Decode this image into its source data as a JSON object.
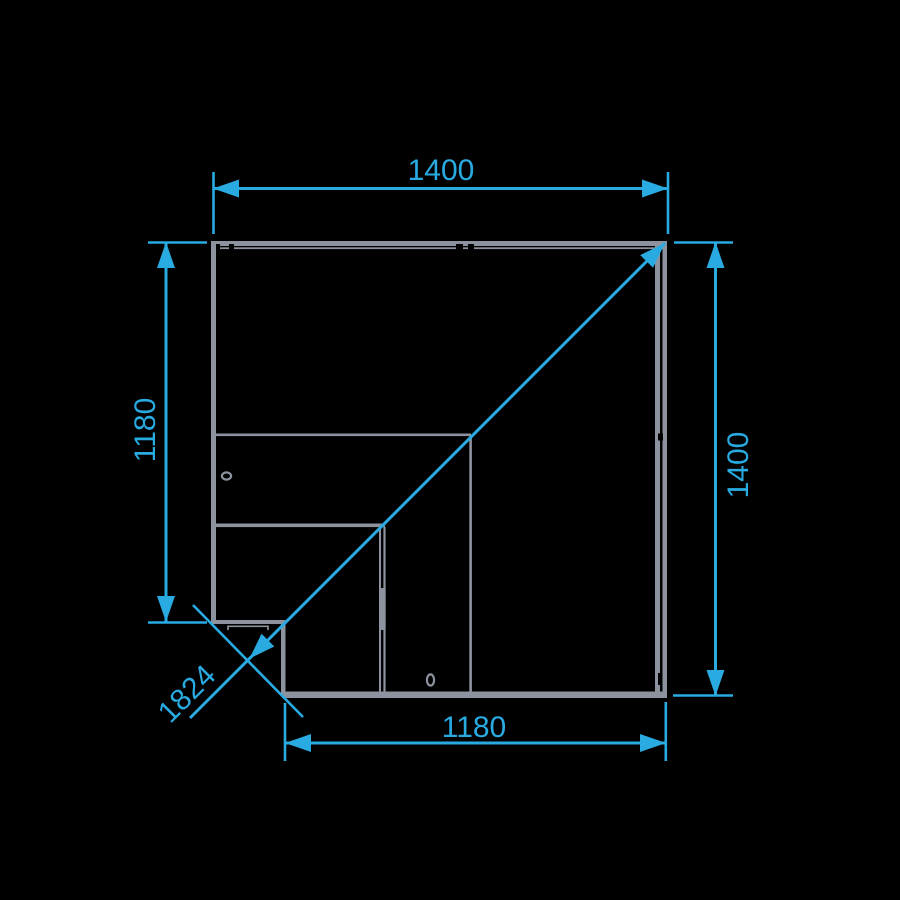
{
  "drawing": {
    "type": "technical-plan-drawing",
    "subject": "corner-counter-unit-top-view",
    "colors": {
      "background": "#000000",
      "outline_gray": "#8D939E",
      "dimension_blue": "#29ABE2"
    },
    "dimensions": {
      "top": {
        "value": "1400",
        "orientation": "horizontal"
      },
      "left": {
        "value": "1180",
        "orientation": "vertical"
      },
      "right": {
        "value": "1400",
        "orientation": "vertical"
      },
      "bottom": {
        "value": "1180",
        "orientation": "horizontal"
      },
      "diagonal": {
        "value": "1824",
        "orientation": "diagonal-45deg"
      }
    }
  }
}
